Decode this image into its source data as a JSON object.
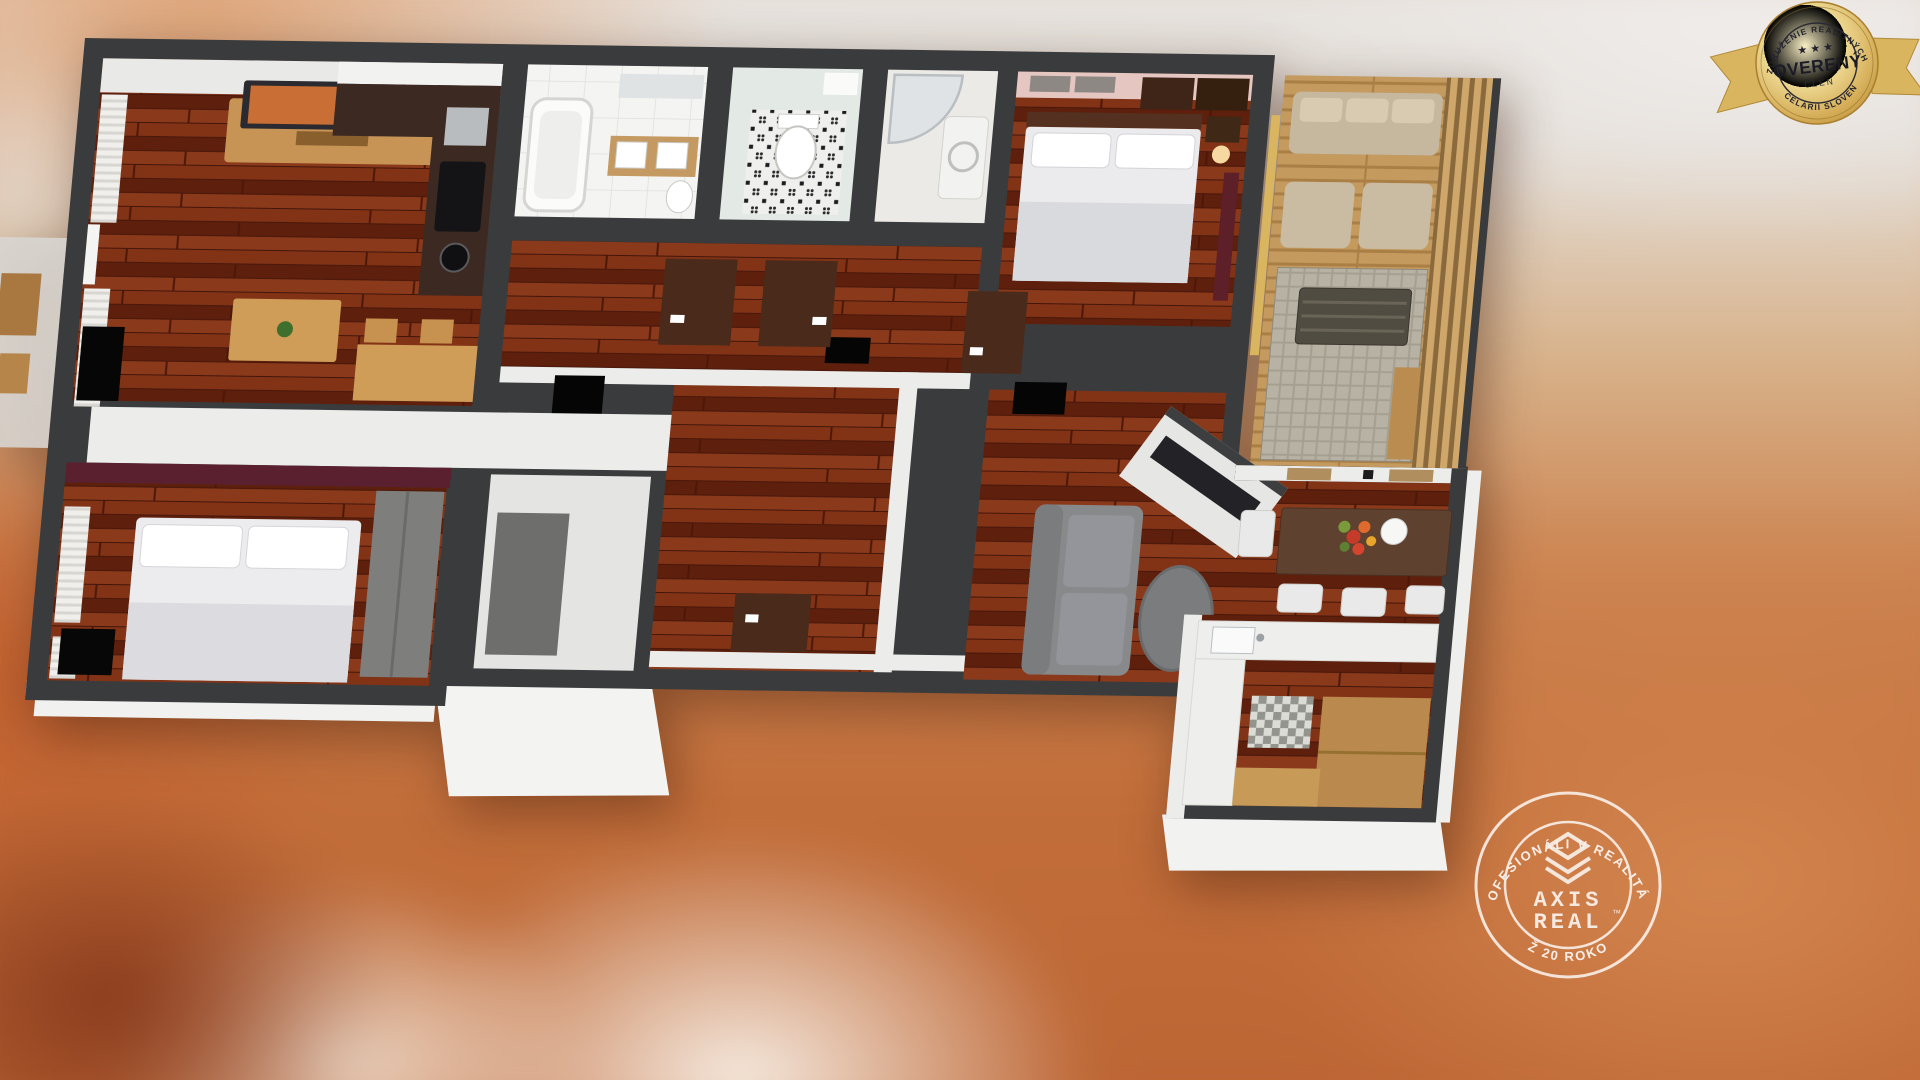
{
  "badge": {
    "top_arc": "ZDRUŽENIE REALITNÝCH",
    "stars": "★ ★ ★",
    "title": "OVERENÝ",
    "member": "ČLEN",
    "bottom_arc": "KANCELÁRIÍ SLOVENSKA",
    "gold": "#d9b55f",
    "text_dark": "#22222e"
  },
  "watermark": {
    "top_arc": "PROFESIONÁLI V REALITÁCH",
    "bottom_arc": "UŽ 20 ROKOV",
    "brand_top": "AXIS",
    "brand_bottom": "REAL",
    "trademark": "™",
    "white": "#ffffff"
  },
  "colors": {
    "wall_dark": "#3a3b3d",
    "wall_white": "#ecedeb",
    "floor_wood": "#76290f",
    "bedroom_pink": "#e5c6c1",
    "accent_maroon": "#5a2030",
    "balcony_deck": "#c09a62",
    "door_brown": "#4a2a1a",
    "gray_furniture": "#88898b",
    "background_orange": "#c76f3e"
  },
  "icons": {
    "seal": "badge-seal-icon",
    "stars": "three-stars-icon",
    "logo": "axis-real-pyramid-icon"
  }
}
